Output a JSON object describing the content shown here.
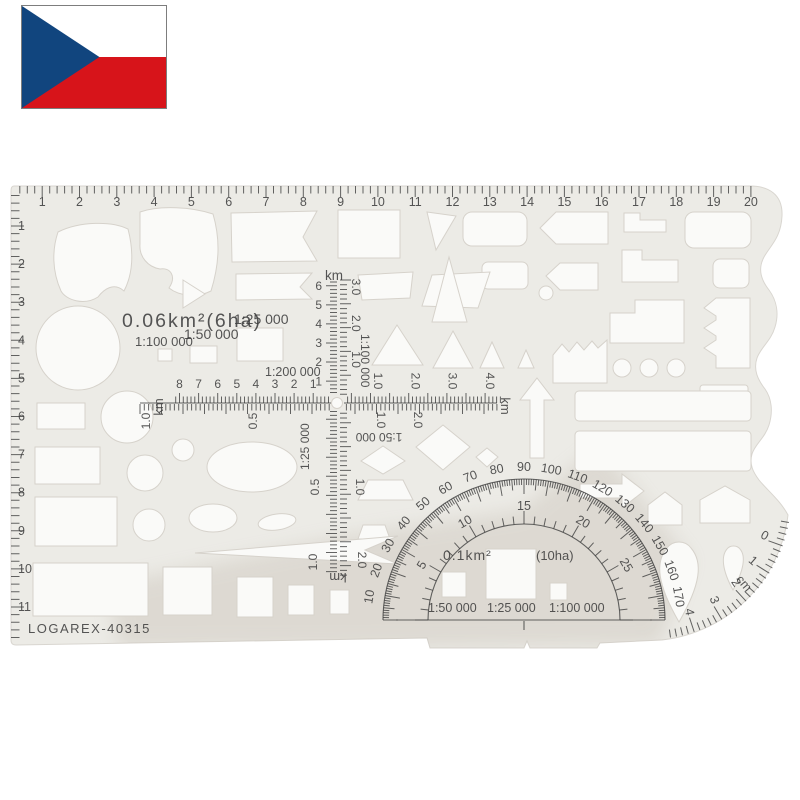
{
  "flag": {
    "country": "czech-republic",
    "colors": {
      "white": "#ffffff",
      "red": "#d7141a",
      "blue": "#11457e"
    }
  },
  "colors": {
    "template_body": "#ecebe6",
    "cutout": "#fafaf8",
    "ink": "#3f3f3f",
    "shadow": "#b3a89b"
  },
  "template": {
    "brand": "LOGAREX-40315",
    "top_ruler": {
      "numbers": [
        "1",
        "2",
        "3",
        "4",
        "5",
        "6",
        "7",
        "8",
        "9",
        "10",
        "11",
        "12",
        "13",
        "14",
        "15",
        "16",
        "17",
        "18",
        "19",
        "20"
      ]
    },
    "left_ruler": {
      "numbers": [
        "1",
        "2",
        "3",
        "4",
        "5",
        "6",
        "7",
        "8",
        "9",
        "10",
        "11"
      ]
    },
    "labels": {
      "area_small": "0.06km²(6ha)",
      "scale_25k": "1:25 000",
      "scale_100k": "1:100 000",
      "scale_50k": "1:50 000",
      "scale_200k": "1:200 000"
    },
    "v_scale": {
      "unit_top": "km",
      "unit_bottom": "km",
      "left_numbers": [
        "6",
        "5",
        "4",
        "3",
        "2",
        "1"
      ],
      "right_numbers": [
        "3.0",
        "2.0",
        "1.0"
      ],
      "scale_label": "1:100 000",
      "lower_left": [
        "0.5",
        "1.0"
      ],
      "lower_right": [
        "1.0",
        "2.0"
      ],
      "lower_scale_label": "1:25 000"
    },
    "h_scale": {
      "unit_left": "km",
      "unit_right": "km",
      "top_numbers": [
        "8",
        "7",
        "6",
        "5",
        "4",
        "3",
        "2",
        "1"
      ],
      "right_numbers": [
        "1.0",
        "2.0",
        "3.0",
        "4.0"
      ],
      "bottom_left": [
        "1.0",
        "0.5"
      ],
      "bottom_right": [
        "1.0",
        "2.0"
      ],
      "bottom_scale_label": "1:50 000"
    },
    "protractor": {
      "outer_degrees": [
        "10",
        "20",
        "30",
        "40",
        "50",
        "60",
        "70",
        "80",
        "90",
        "100",
        "110",
        "120",
        "130",
        "140",
        "150",
        "160",
        "170"
      ],
      "inner_numbers": [
        "5",
        "10",
        "15",
        "20",
        "25"
      ],
      "area_label": "0.1km²",
      "area_label_ha": "(10ha)",
      "base_scales": [
        "1:50 000",
        "1:25 000",
        "1:100 000"
      ]
    },
    "cm_scale": {
      "unit": "cm",
      "numbers": [
        "0",
        "1",
        "2",
        "3",
        "4"
      ]
    }
  }
}
